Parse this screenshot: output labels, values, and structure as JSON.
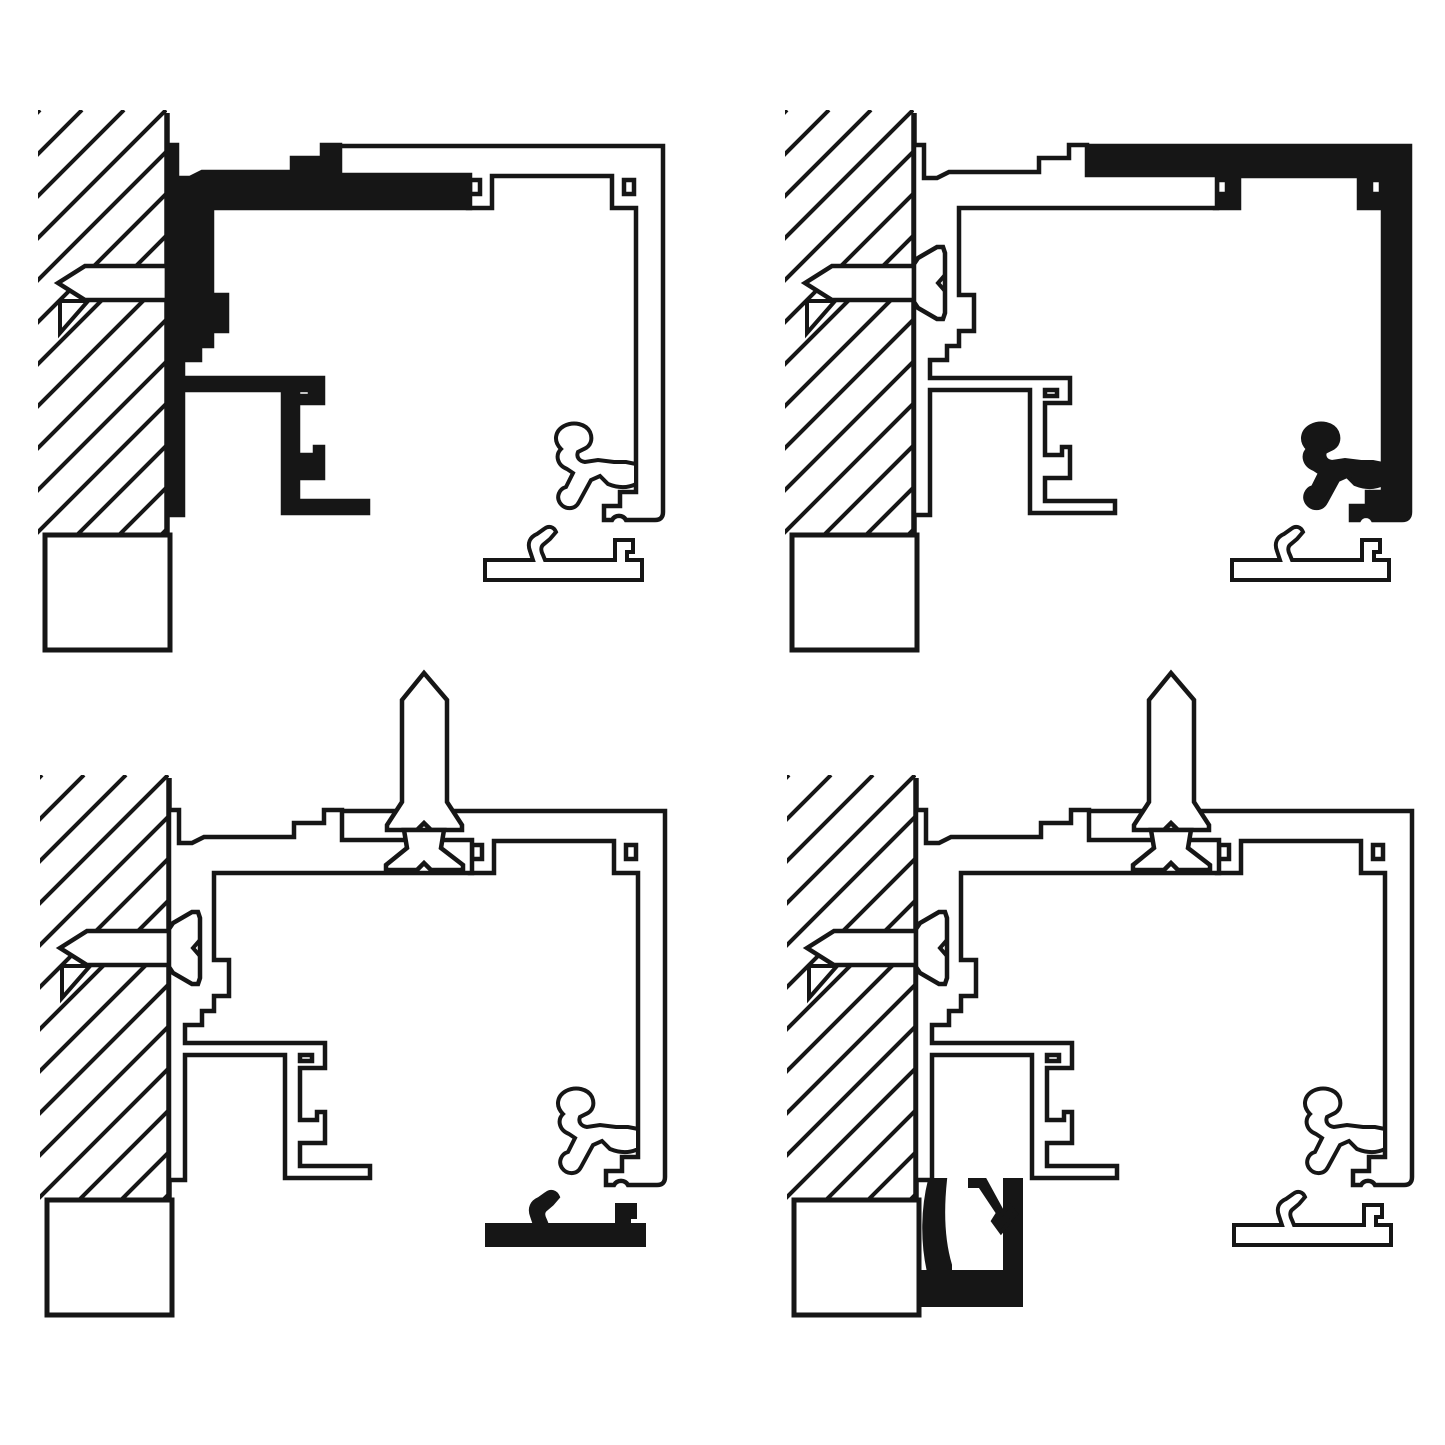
{
  "figure": {
    "kind": "technical line diagram",
    "subject": "aluminium frame profile wall-mounting cross-sections, 4 steps",
    "background_color": "#ffffff",
    "ink_color": "#161616",
    "highlight_fill": "#161616",
    "panel_count": 4
  },
  "panels": [
    {
      "id": "top-left",
      "highlighted_component": "wall-bracket-profile",
      "parts": [
        "masonry-wall",
        "sill-block",
        "anchor-screw",
        "wall-bracket-profile",
        "frame-rail-profile",
        "retainer-clip",
        "mounting-plate"
      ]
    },
    {
      "id": "top-right",
      "highlighted_component": "frame-rail-profile",
      "parts": [
        "masonry-wall",
        "sill-block",
        "anchor-screw",
        "wall-bracket-profile",
        "frame-rail-profile",
        "retainer-clip",
        "mounting-plate"
      ]
    },
    {
      "id": "bottom-left",
      "highlighted_component": "mounting-plate",
      "parts": [
        "masonry-wall",
        "sill-block",
        "anchor-screw",
        "adjustment-screw",
        "wall-bracket-profile",
        "frame-rail-profile",
        "retainer-clip",
        "mounting-plate"
      ]
    },
    {
      "id": "bottom-right",
      "highlighted_component": "cover-channel-profile",
      "parts": [
        "masonry-wall",
        "sill-block",
        "anchor-screw",
        "adjustment-screw",
        "wall-bracket-profile",
        "frame-rail-profile",
        "retainer-clip",
        "cover-channel-profile",
        "mounting-plate"
      ]
    }
  ]
}
